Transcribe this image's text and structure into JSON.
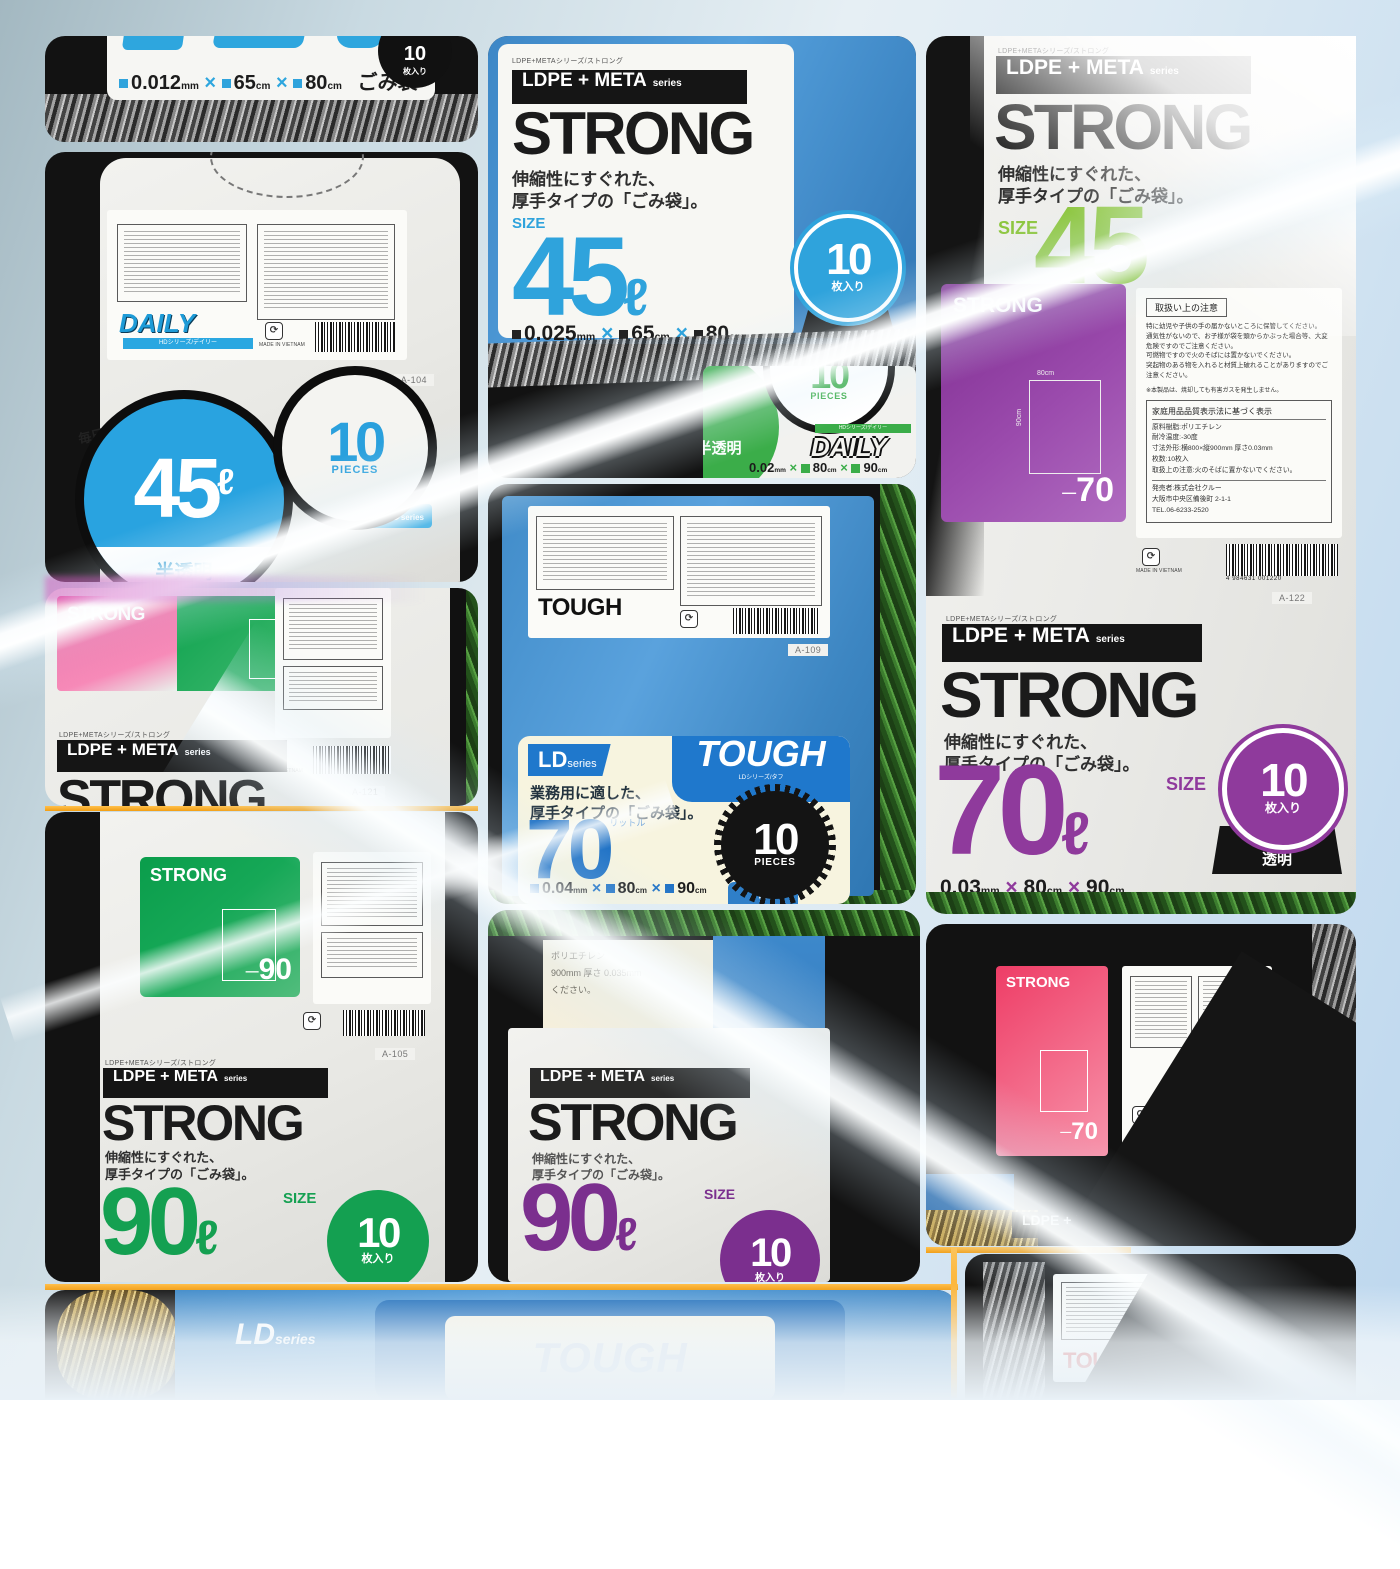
{
  "collage": {
    "care_label": {
      "title": "取扱い上の注意",
      "bullets": [
        "特に幼児や子供の手の届かないところに保管してください。",
        "通気性がないので、お子様が袋を頭からかぶった場合等、大変危険ですのでご注意ください。",
        "可燃物ですので火のそばには置かないでください。",
        "突起物のある物を入れると材質上破れることがありますのでご注意ください。"
      ],
      "note": "※本製品は、焼却しても有害ガスを発生しません。",
      "quality_title": "家庭用品品質表示法に基づく表示",
      "specs": [
        "原料樹脂:ポリエチレン",
        "耐冷温度:-30度",
        "寸法外形:横800×縦900mm 厚さ0.03mm",
        "枚数:10枚入",
        "取扱上の注意:火のそばに置かないでください。"
      ],
      "seller": "発売者:株式会社クルー",
      "address": "大阪市中央区備後町 2-1-1",
      "tel": "TEL.06-6233-2520",
      "made_in": "MADE IN VIETNAM",
      "barcode_digits": "4 984631 001220"
    },
    "strong_series": {
      "tiny": "LDPE+METAシリーズ/ストロング",
      "banner": "LDPE + META",
      "banner_suffix": "series",
      "name": "STRONG",
      "desc1": "伸縮性にすぐれた、",
      "desc2": "厚手タイプの「ごみ袋」。",
      "size_label": "SIZE"
    },
    "cell_top_left": {
      "thickness": "0.012",
      "mm": "mm",
      "width": "65",
      "cm": "cm",
      "height": "80",
      "product": "ごみ袋",
      "count": "10",
      "count_suffix": "枚入り"
    },
    "cell_daily": {
      "brand": "DAILY",
      "brand_sub": "HDシリーズ/デイリー",
      "badge": "HD",
      "badge_suffix": "series",
      "tagline1": "毎日の生活に…",
      "tagline2": "汎用性の高い「ごみ袋」",
      "size": "45",
      "size_unit": "ℓ",
      "finish": "半透明",
      "count": "10",
      "count_label": "PIECES",
      "item_code": "A-104"
    },
    "cell_pink70": {
      "name": "STRONG",
      "size": "70",
      "item_code": "A-121"
    },
    "cell_green90": {
      "name": "STRONG",
      "back_size": "90",
      "item_code": "A-105",
      "size": "90",
      "size_unit": "ℓ",
      "count": "10",
      "count_suffix": "枚入り"
    },
    "cell_strong45": {
      "size": "45",
      "size_unit": "ℓ",
      "thickness": "0.025",
      "mm": "mm",
      "width": "65",
      "cm": "cm",
      "height": "80",
      "count": "10",
      "count_suffix": "枚入り"
    },
    "cell_daily_green": {
      "count": "10",
      "count_label": "PIECES",
      "finish": "半透明",
      "brand": "DAILY",
      "brand_sub": "HDシリーズ/デイリー",
      "thickness": "0.02",
      "width": "80",
      "height": "90"
    },
    "cell_tough": {
      "back_logo": "TOUGH",
      "item_code": "A-109",
      "series": "LD",
      "series_suffix": "series",
      "series_sub": "LDシリーズ/タフ",
      "logo": "TOUGH",
      "desc1": "業務用に適した、",
      "desc2": "厚手タイプの「ごみ袋」。",
      "size": "70",
      "size_kana": "リットル",
      "count": "10",
      "count_label": "PIECES",
      "thickness": "0.04",
      "mm": "mm",
      "width": "80",
      "cm": "cm",
      "height": "90",
      "color_tab": "青"
    },
    "cell_strong90": {
      "size": "90",
      "size_unit": "ℓ",
      "count": "10",
      "count_suffix": "枚入り",
      "back_line1": "ポリエチレン",
      "back_line2": "900mm 厚さ 0.035mm",
      "back_line3": "ください。"
    },
    "cell_right": {
      "size45": "45",
      "back_name": "STRONG",
      "dim_top": "80cm",
      "dim_side": "90cm",
      "back_size": "70",
      "item_code": "A-122",
      "size": "70",
      "size_unit": "ℓ",
      "thickness": "0.03",
      "mm": "mm",
      "width": "80",
      "cm": "cm",
      "height": "90",
      "count": "10",
      "count_suffix": "枚入り",
      "finish": "透明"
    },
    "cell_black70": {
      "name": "STRONG",
      "size": "70",
      "item_code": "A-119"
    },
    "cell_bottom": {
      "series": "LD",
      "series_suffix": "series",
      "logo": "TOUGH"
    },
    "cell_tough_back": {
      "logo": "TOUGH"
    }
  }
}
